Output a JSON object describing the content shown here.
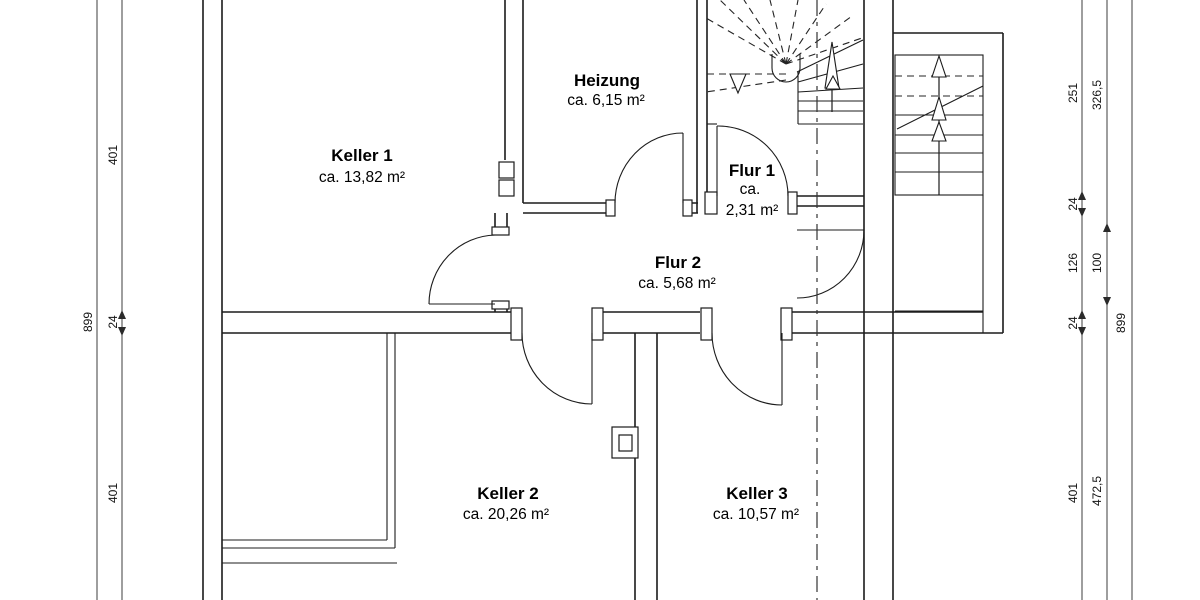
{
  "plan": {
    "type": "basement floor plan",
    "colors": {
      "wall": "#1c1c1c",
      "dimension_line": "#3c3c3c",
      "text": "#000000",
      "background": "#ffffff"
    }
  },
  "rooms": [
    {
      "id": "keller-1",
      "name": "Keller 1",
      "area": "ca. 13,82 m²"
    },
    {
      "id": "heizung",
      "name": "Heizung",
      "area": "ca. 6,15 m²"
    },
    {
      "id": "flur-1",
      "name": "Flur 1",
      "area_l1": "ca.",
      "area_l2": "2,31 m²"
    },
    {
      "id": "flur-2",
      "name": "Flur 2",
      "area": "ca. 5,68 m²"
    },
    {
      "id": "keller-2",
      "name": "Keller 2",
      "area": "ca. 20,26 m²"
    },
    {
      "id": "keller-3",
      "name": "Keller 3",
      "area": "ca. 10,57 m²"
    }
  ],
  "dimensions": {
    "left_outer": "899",
    "left_inner": [
      "401",
      "24",
      "401"
    ],
    "right_inner": [
      "251",
      "24",
      "126",
      "24",
      "401"
    ],
    "right_mid": [
      "326,5",
      "100",
      "472,5"
    ],
    "right_outer": "899"
  }
}
